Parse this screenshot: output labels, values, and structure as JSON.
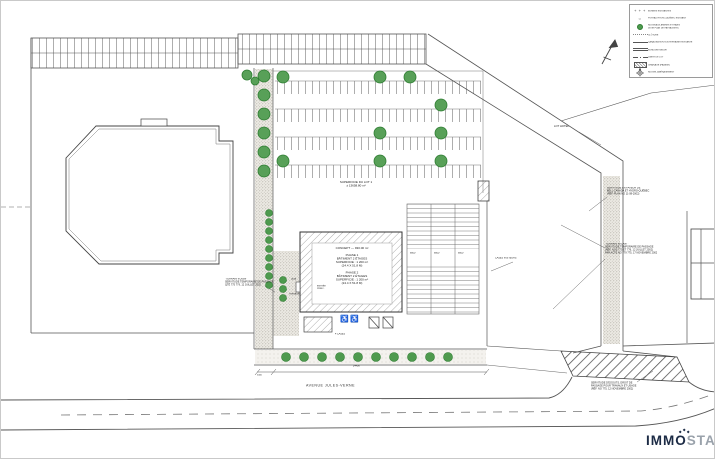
{
  "legend": {
    "items": [
      {
        "sym": "+ + +",
        "label": "BORNES EXISTANTES"
      },
      {
        "sym": "○",
        "label": "POTEAU HYDRO-QUÉBEC EXISTANT"
      },
      {
        "label": "NOUVEAUX ARBRES ET HAIES",
        "label2": "(VOIR PLAN DE PAYSAGISTE)"
      },
      {
        "label": "CLÔTURE"
      },
      {
        "label": "CANALISATION SOUTERRAINE EXISTANTE"
      },
      {
        "label": "BORDURE NEUVE"
      },
      {
        "label": "LIMITE DE LOT"
      },
      {
        "label": "CHAÎNAGE (PAVAGE)"
      },
      {
        "label": "NOUVEL AMÉNAGEMENT"
      }
    ]
  },
  "site": {
    "superficie_line1": "SUPERFICIE DU LOT 1",
    "superficie_line2": "± 13658.80 m²",
    "avenue": "AVENUE JULES-VERNE",
    "lot_hotel": "LOT HOTEL",
    "quai": "QUAI",
    "terrasse": "TERRASSE",
    "entree_line1": "ENTRÉE",
    "entree_line2": "PRINC.",
    "cases": "4 CASES",
    "cases_visiteurs": "CASES VISITEURS"
  },
  "building": {
    "lines": [
      "CONCEPT — 930.00 m²",
      "",
      "PHASE 1",
      "BÂTIMENT 2 ÉTAGES",
      "SUPERFICIE : 1 200 m²",
      "(24.4 X 51.8 M)",
      "",
      "PHASE 2",
      "BÂTIMENT 2 ÉTAGES",
      "SUPERFICIE : 1 200 m²",
      "(24.4 X 51.8 M)"
    ]
  },
  "notes": {
    "west": {
      "lines": [
        "\"TERRAIN VOISIN\"",
        "SERVITUDE TEMPORAIRE DE PASSAGE",
        "QTÉ 775 779, 12 JUILLET 2002"
      ]
    },
    "east_top": {
      "lines": [
        "SERVITUDE EN FAVEUR DE",
        "BELL CANADA ET HYDRO-QUÉBEC",
        "(RÉF. PLAN NO 11-08-2002)"
      ]
    },
    "east_mid": {
      "lines": [
        "\"TERRAIN VACANT\"",
        "SERVITUDE TEMPORAIRE DE PASSAGE",
        "(RÉF. NOS 775 ET 776, 12 JUILLET 2002)",
        "PAR ACTE NO 779 775, 17 NOVEMBRE 2002"
      ]
    },
    "south_east": {
      "lines": [
        "SERVITUDE D'ÉGOUTS, DROIT DE",
        "PASSAGE POUR TRAVAUX ET USAGE",
        "(RÉF. NO 775, 12 NOVEMBRE 2002)"
      ]
    }
  },
  "dims": {
    "stall": "6000",
    "frontage": "24400",
    "offset": "5000"
  },
  "icons": {
    "wheelchair": "♿"
  },
  "logo": {
    "immo": "IMMO",
    "star": "STAR"
  },
  "colors": {
    "tree": "#4e9a4e",
    "line": "#555555",
    "logo_dark": "#1c2b45",
    "logo_gray": "#9aa2ab"
  }
}
